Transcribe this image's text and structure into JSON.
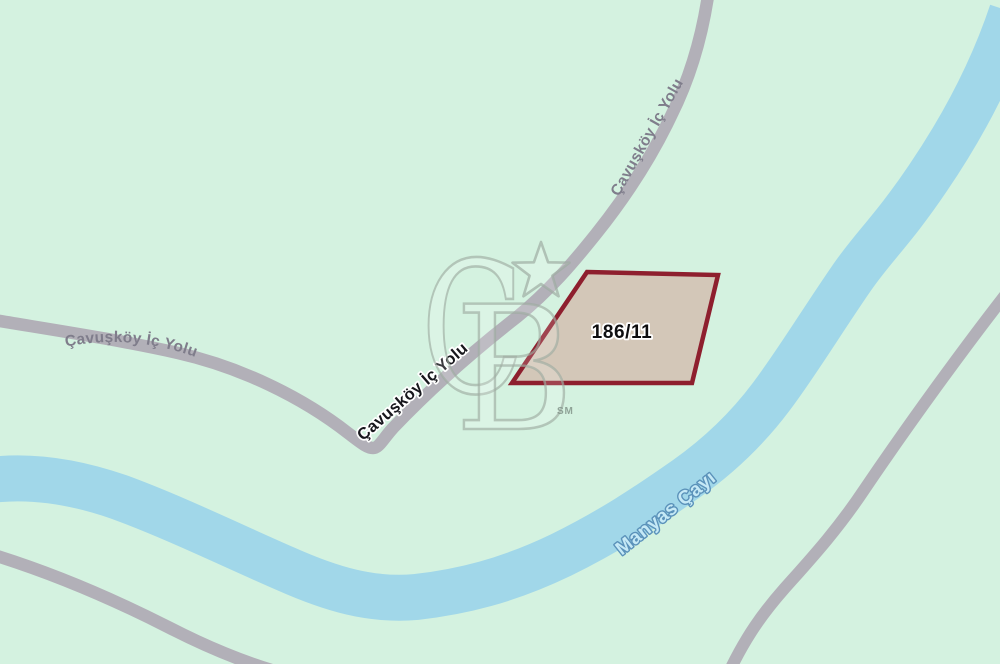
{
  "map": {
    "road": {
      "label": "Çavuşköy İç Yolu"
    },
    "river": {
      "label": "Manyas Çayı"
    },
    "parcel": {
      "label": "186/11"
    },
    "watermark": {
      "letter_c": "C",
      "letter_b": "B",
      "service_mark": "SM"
    },
    "colors": {
      "background": "#d4f2e0",
      "road": "#b2b0b8",
      "road_label": "#7f7d8b",
      "river": "#a1d7e9",
      "river_label_fill": "#c5e9f6",
      "river_label_stroke": "#5b92ba",
      "parcel_fill": "#d2c5b6",
      "parcel_border": "#8e1f2e"
    }
  }
}
